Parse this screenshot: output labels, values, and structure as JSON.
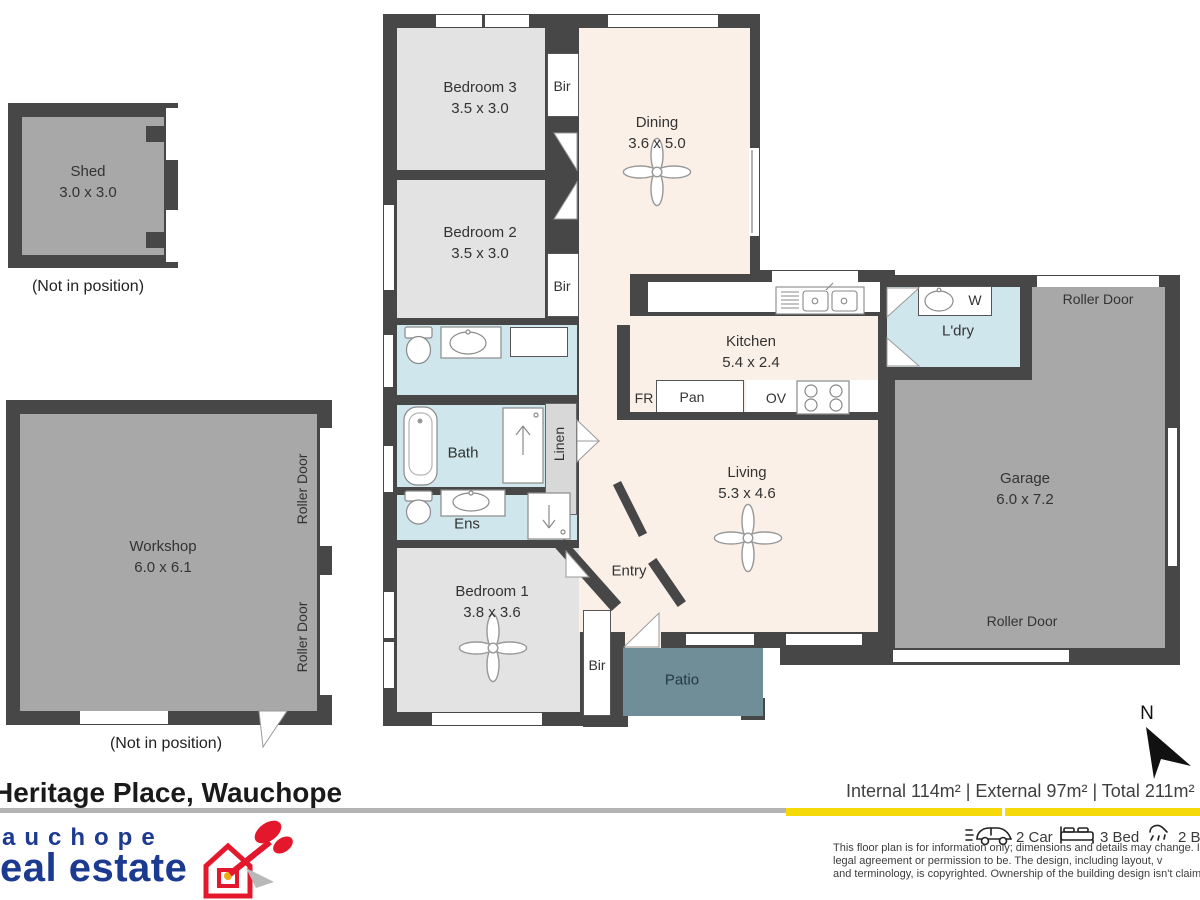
{
  "plan": {
    "rooms": {
      "shed": {
        "name": "Shed",
        "dims": "3.0 x 3.0"
      },
      "workshop": {
        "name": "Workshop",
        "dims": "6.0 x 6.1"
      },
      "bedroom3": {
        "name": "Bedroom 3",
        "dims": "3.5 x 3.0"
      },
      "bedroom2": {
        "name": "Bedroom 2",
        "dims": "3.5 x 3.0"
      },
      "bedroom1": {
        "name": "Bedroom 1",
        "dims": "3.8 x 3.6"
      },
      "dining": {
        "name": "Dining",
        "dims": "3.6 x 5.0"
      },
      "kitchen": {
        "name": "Kitchen",
        "dims": "5.4 x 2.4"
      },
      "living": {
        "name": "Living",
        "dims": "5.3 x 4.6"
      },
      "garage": {
        "name": "Garage",
        "dims": "6.0 x 7.2"
      },
      "bath": {
        "name": "Bath"
      },
      "ens": {
        "name": "Ens"
      },
      "linen": {
        "name": "Linen"
      },
      "laundry": {
        "name": "L'dry"
      },
      "entry": {
        "name": "Entry"
      },
      "patio": {
        "name": "Patio"
      }
    },
    "fixtures": {
      "bir": "Bir",
      "fridge": "FR",
      "pantry": "Pan",
      "oven": "OV",
      "washer": "W",
      "roller_door": "Roller Door"
    },
    "notes": {
      "not_in_position": "(Not in position)"
    },
    "compass": {
      "label": "N"
    }
  },
  "footer": {
    "address": "Heritage Place, Wauchope",
    "areas_line": "Internal 114m²   |   External 97m² | Total 211m²",
    "features": {
      "car": "2 Car",
      "bed": "3 Bed",
      "bath": "2 Bath"
    },
    "disclaimer": [
      "This floor plan is for information only; dimensions and details may change. It's n",
      "legal agreement or permission to be. The design, including layout, v",
      "and terminology, is copyrighted. Ownership of the building design isn't claimed"
    ],
    "logo": {
      "line1": "auchope",
      "line2": "eal estate"
    }
  },
  "colors": {
    "wall": "#474747",
    "floor_cream": "#fbf0e8",
    "floor_grey": "#e3e3e3",
    "floor_blue": "#cfe6ec",
    "floor_garage": "#a8a8a8",
    "floor_patio": "#6f8e97",
    "accent_yellow": "#f6d909",
    "logo_blue": "#1c3a90",
    "logo_red": "#e4182d"
  }
}
